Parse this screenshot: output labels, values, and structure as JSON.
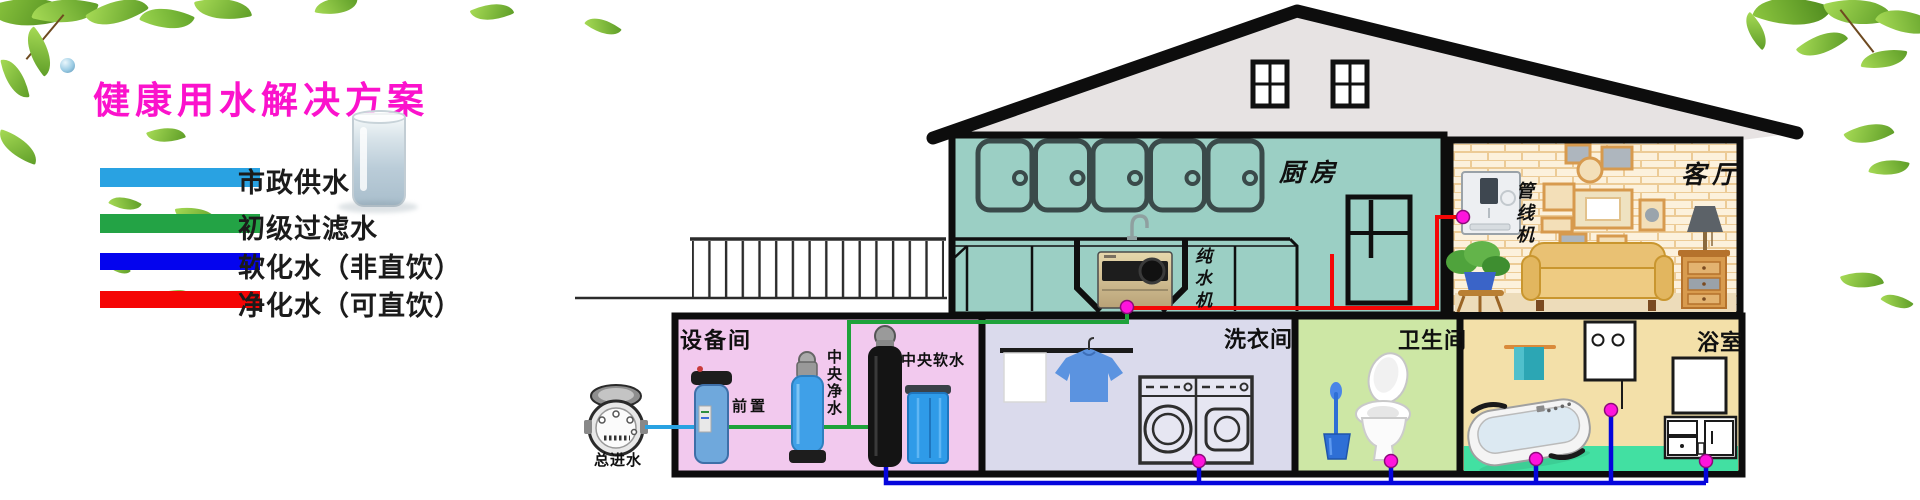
{
  "title": "健康用水解决方案",
  "legend": {
    "items": [
      {
        "label": "市政供水",
        "color": "#29A2E2"
      },
      {
        "label": "初级过滤水",
        "color": "#23A345"
      },
      {
        "label": "软化水（非直饮）",
        "color": "#0404EE"
      },
      {
        "label": "净化水（可直饮）",
        "color": "#F50505"
      }
    ]
  },
  "house": {
    "rooms": {
      "kitchen": "厨房",
      "living": "客厅",
      "equipment": "设备间",
      "laundry": "洗衣间",
      "toilet": "卫生间",
      "bath": "浴室"
    },
    "appliances": {
      "pure_water": "纯水机",
      "pipeline": "管线机",
      "prefilter": "前置",
      "purifier": "中央净水",
      "softener": "中央软水"
    },
    "meter": {
      "label": "总进水"
    }
  },
  "pipes": {
    "municipal": "#29A2E2",
    "filtered": "#1EA23A",
    "softened": "#0505DC",
    "purified": "#F40606",
    "joint": "#FF14DC"
  }
}
